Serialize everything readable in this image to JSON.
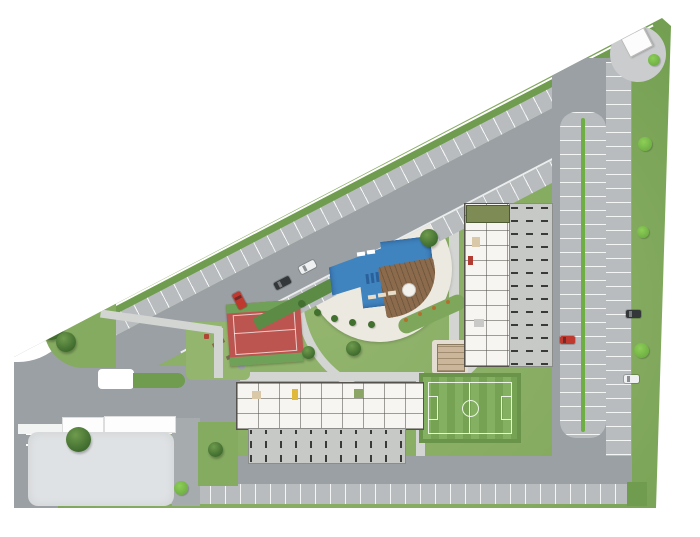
{
  "meta": {
    "type": "architectural-site-plan",
    "description": "Aerial site plan of a triangular residential complex with perimeter roads, parking, two residential blocks, pool, sports court, soccer field, playground and guardhouse",
    "text_labels": []
  },
  "palette": {
    "road": "#9aa0a4",
    "road_dark": "#8f959a",
    "parking": "#b8bcbf",
    "lawn": "#85ab60",
    "lawn_light": "#93b56e",
    "lawn_dark": "#6f9c4e",
    "field_green": "#7cab58",
    "field_border": "#6a9449",
    "deck": "#ece9e1",
    "path": "#d3d5d2",
    "pool_blue": "#3f83bf",
    "pool_dark": "#2b619b",
    "wood": "#8b6b4c",
    "court_red": "#bc554f",
    "court_green": "#6fa258",
    "bld_wall": "#55524d",
    "bld_fill": "#f7f5f1",
    "garage": "#c7c9c7",
    "dash": "#3a3a38",
    "tree_dark": "#3f6b2e",
    "tree_light": "#6e9b4d",
    "bush": "#6fae44",
    "lot": "#dfe2e4",
    "hedge": "#5c8b45",
    "bed_green": "#7fa75c",
    "shrub_orange": "#b2702f",
    "car_red": "#c0392f",
    "car_black": "#33373a",
    "car_white": "#eef0f1",
    "boundary_line": "#ffffff"
  },
  "inventory": {
    "residential_blocks": 2,
    "swimming_pool": 1,
    "wood_sun_deck": 1,
    "sports_court": 1,
    "soccer_field": 1,
    "playground": 1,
    "guardhouse": 1,
    "pergola": 1,
    "parked_cars": [
      {
        "color": "white",
        "location": "main-avenue"
      },
      {
        "color": "black",
        "location": "main-avenue"
      },
      {
        "color": "red",
        "location": "main-avenue-stalls"
      },
      {
        "color": "red",
        "location": "east-parking-island"
      },
      {
        "color": "black",
        "location": "east-edge-stalls"
      },
      {
        "color": "white",
        "location": "east-edge-stalls"
      }
    ],
    "trees": 7,
    "bushes": 5
  }
}
